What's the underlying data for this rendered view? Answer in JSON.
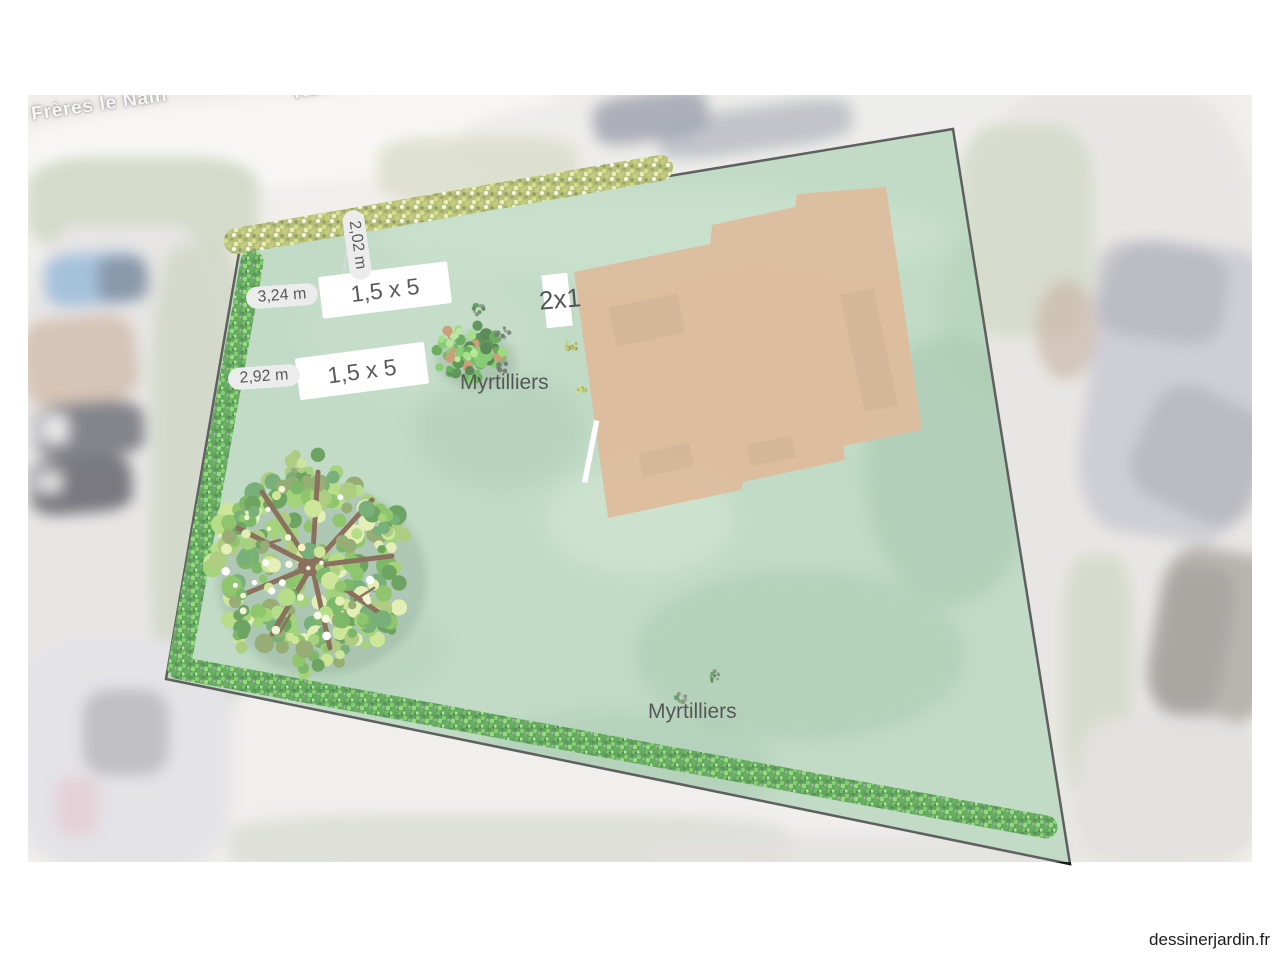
{
  "watermark": {
    "text": "dessinerjardin.fr"
  },
  "map": {
    "street_labels": [
      "Frères le Nain",
      "Rue des"
    ]
  },
  "garden": {
    "beds": [
      {
        "label": "1,5 x 5"
      },
      {
        "label": "1,5 x 5"
      },
      {
        "label": "2x1"
      }
    ],
    "measurements": [
      "2,02 m",
      "3,24 m",
      "2,92 m"
    ],
    "plant_labels": [
      "Myrtilliers",
      "Myrtilliers"
    ],
    "colors": {
      "plot_fill": "#a6ccae",
      "plot_border": "#1a1a1a",
      "building_fill": "#d0a173",
      "bed_box_bg": "#ffffff",
      "measure_pill_bg": "#e4e4e4",
      "hedge_green": "#1f7e1b",
      "hedge_olive": "#97a43e",
      "tree_trunk": "#5a3418"
    }
  },
  "palettes": {
    "tree": [
      "#2e7d1e",
      "#46982a",
      "#5fae2e",
      "#7cc043",
      "#97cf55",
      "#b8dc6f",
      "#d9e898",
      "#6a8a3a",
      "#3f8f3f",
      "#8cb84c"
    ],
    "tree_hi": [
      "#f2f5d8",
      "#ffffff",
      "#ffe9a8",
      "#e8f0c0"
    ],
    "bush": [
      "#1d6b15",
      "#2c8a1e",
      "#3da02a",
      "#55b838",
      "#77cc4d",
      "#155a10",
      "#b5763f",
      "#2c8a1e"
    ],
    "bush_hi": [
      "#7ed45a",
      "#98e070"
    ],
    "sprig_dark": [
      "#1e5c1e",
      "#2d742d",
      "#4a8a3a",
      "#5a6a5a"
    ],
    "sprig_gray": [
      "#4a5a4a",
      "#6a7a6a",
      "#3a4a3a",
      "#7a8a7a"
    ],
    "sprig_yellow": [
      "#8a9a2a",
      "#aab83a",
      "#c8d25a",
      "#6a7a20"
    ]
  }
}
